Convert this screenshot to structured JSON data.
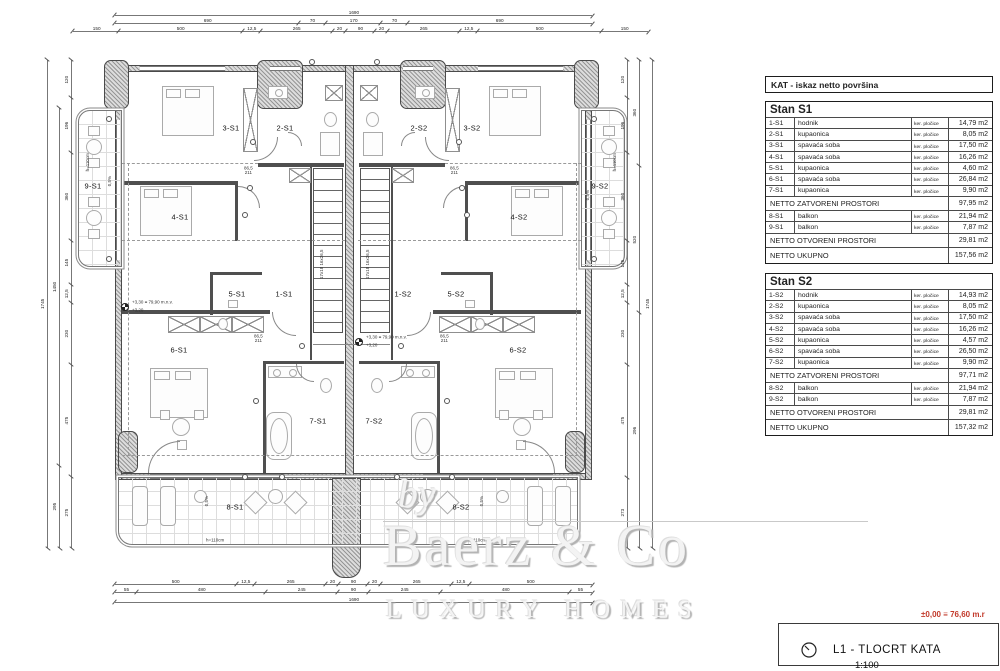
{
  "panel": {
    "header": "KAT - iskaz netto površina",
    "tables": [
      {
        "title": "Stan S1",
        "rows": [
          {
            "code": "1-S1",
            "name": "hodnik",
            "finish": "ker. pločice",
            "area": "14,79 m2"
          },
          {
            "code": "2-S1",
            "name": "kupaonica",
            "finish": "ker. pločice",
            "area": "8,05 m2"
          },
          {
            "code": "3-S1",
            "name": "spavaća soba",
            "finish": "ker. pločice",
            "area": "17,50 m2"
          },
          {
            "code": "4-S1",
            "name": "spavaća soba",
            "finish": "ker. pločice",
            "area": "16,26 m2"
          },
          {
            "code": "5-S1",
            "name": "kupaonica",
            "finish": "ker. pločice",
            "area": "4,60 m2"
          },
          {
            "code": "6-S1",
            "name": "spavaća soba",
            "finish": "ker. pločice",
            "area": "26,84 m2"
          },
          {
            "code": "7-S1",
            "name": "kupaonica",
            "finish": "ker. pločice",
            "area": "9,90 m2"
          }
        ],
        "subtotal_closed": {
          "label": "NETTO ZATVORENI PROSTORI",
          "area": "97,95 m2"
        },
        "open_rows": [
          {
            "code": "8-S1",
            "name": "balkon",
            "finish": "ker. pločice",
            "area": "21,94 m2"
          },
          {
            "code": "9-S1",
            "name": "balkon",
            "finish": "ker. pločice",
            "area": "7,87 m2"
          }
        ],
        "subtotal_open": {
          "label": "NETTO OTVORENI PROSTORI",
          "area": "29,81 m2"
        },
        "total": {
          "label": "NETTO UKUPNO",
          "area": "157,56 m2"
        }
      },
      {
        "title": "Stan S2",
        "rows": [
          {
            "code": "1-S2",
            "name": "hodnik",
            "finish": "ker. pločice",
            "area": "14,93 m2"
          },
          {
            "code": "2-S2",
            "name": "kupaonica",
            "finish": "ker. pločice",
            "area": "8,05 m2"
          },
          {
            "code": "3-S2",
            "name": "spavaća soba",
            "finish": "ker. pločice",
            "area": "17,50 m2"
          },
          {
            "code": "4-S2",
            "name": "spavaća soba",
            "finish": "ker. pločice",
            "area": "16,26 m2"
          },
          {
            "code": "5-S2",
            "name": "kupaonica",
            "finish": "ker. pločice",
            "area": "4,57 m2"
          },
          {
            "code": "6-S2",
            "name": "spavaća soba",
            "finish": "ker. pločice",
            "area": "26,50 m2"
          },
          {
            "code": "7-S2",
            "name": "kupaonica",
            "finish": "ker. pločice",
            "area": "9,90 m2"
          }
        ],
        "subtotal_closed": {
          "label": "NETTO ZATVORENI PROSTORI",
          "area": "97,71 m2"
        },
        "open_rows": [
          {
            "code": "8-S2",
            "name": "balkon",
            "finish": "ker. pločice",
            "area": "21,94 m2"
          },
          {
            "code": "9-S2",
            "name": "balkon",
            "finish": "ker. pločice",
            "area": "7,87 m2"
          }
        ],
        "subtotal_open": {
          "label": "NETTO OTVORENI PROSTORI",
          "area": "29,81 m2"
        },
        "total": {
          "label": "NETTO UKUPNO",
          "area": "157,32 m2"
        }
      }
    ]
  },
  "plan": {
    "rooms": [
      {
        "label": "3-S1"
      },
      {
        "label": "2-S1"
      },
      {
        "label": "2-S2"
      },
      {
        "label": "3-S2"
      },
      {
        "label": "9-S1"
      },
      {
        "label": "9-S2"
      },
      {
        "label": "4-S1"
      },
      {
        "label": "4-S2"
      },
      {
        "label": "5-S1"
      },
      {
        "label": "1-S1"
      },
      {
        "label": "1-S2"
      },
      {
        "label": "5-S2"
      },
      {
        "label": "6-S1"
      },
      {
        "label": "6-S2"
      },
      {
        "label": "7-S1"
      },
      {
        "label": "7-S2"
      },
      {
        "label": "8-S1"
      },
      {
        "label": "8-S2"
      }
    ],
    "stair_note": {
      "line1": "17x18",
      "line2": "16x26,5"
    },
    "level_note": {
      "main": "+3,30 ≡ 79,90 m.n.v.",
      "sub": "+3,20"
    },
    "door_tag": {
      "w": "86,5",
      "h": "211"
    },
    "slope_note": "0,5%",
    "height_note": "h=110cm"
  },
  "dims": {
    "top1": [
      "1690"
    ],
    "top2": [
      "690",
      "70",
      "170",
      "70",
      "690"
    ],
    "top3": [
      "150",
      "500",
      "12,5",
      "265",
      "20",
      "90",
      "20",
      "265",
      "12,5",
      "500",
      "150"
    ],
    "bottom1": [
      "500",
      "12,5",
      "265",
      "20",
      "90",
      "20",
      "265",
      "12,5",
      "500"
    ],
    "bottom2": [
      "55",
      "480",
      "245",
      "90",
      "245",
      "480",
      "55"
    ],
    "bottom3": [
      "1690"
    ],
    "left1": [
      "120",
      "196",
      "360",
      "145",
      "12,5",
      "230",
      "475",
      "275"
    ],
    "left2": [
      "1450",
      "295"
    ],
    "left3": [
      "1745"
    ],
    "right1": [
      "120",
      "196",
      "360",
      "145",
      "12,5",
      "230",
      "475",
      "273"
    ],
    "right2": [
      "360",
      "520",
      "296"
    ],
    "right3": [
      "1745"
    ]
  },
  "watermark": {
    "by": "by",
    "brand": "Baerz & Co",
    "tagline": "LUXURY HOMES"
  },
  "title_block": {
    "elevation_note": "±0,00 ≡ 76,60 m.r",
    "code": "L1 - TLOCRT KATA",
    "scale": "1:100"
  },
  "colors": {
    "red_note": "#c23a2b",
    "wall": "#4f4f4f"
  }
}
